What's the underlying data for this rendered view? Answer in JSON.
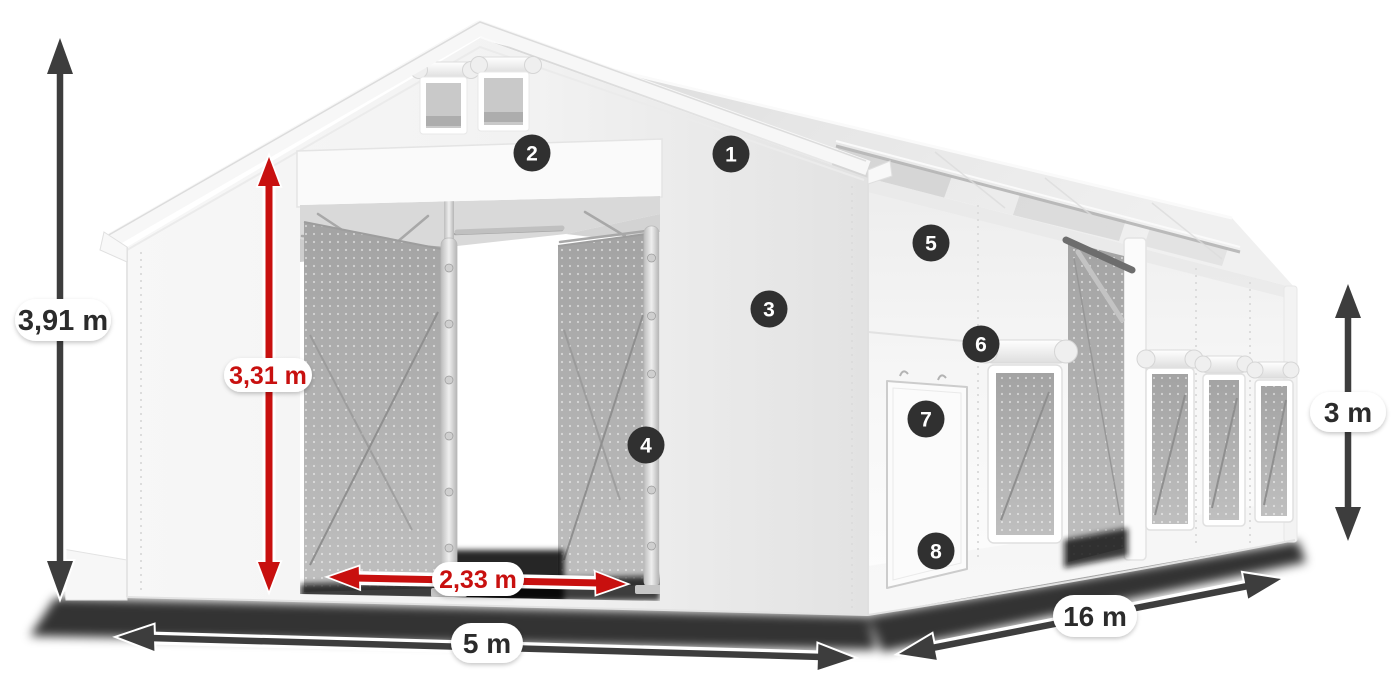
{
  "illustration": {
    "title": "Tent dimensions diagram",
    "subject": "White tarpaulin storage tent with open gable doors, side door, mesh windows, numbered feature callouts and dimension arrows"
  },
  "dimensions": {
    "total_height": {
      "label": "3,91 m",
      "style": "dark"
    },
    "inner_height": {
      "label": "3,31 m",
      "style": "red"
    },
    "door_width": {
      "label": "2,33 m",
      "style": "red"
    },
    "front_width": {
      "label": "5 m",
      "style": "dark"
    },
    "side_length": {
      "label": "16 m",
      "style": "dark"
    },
    "side_height": {
      "label": "3 m",
      "style": "dark"
    }
  },
  "callouts": [
    {
      "number": "1"
    },
    {
      "number": "2"
    },
    {
      "number": "3"
    },
    {
      "number": "4"
    },
    {
      "number": "5"
    },
    {
      "number": "6"
    },
    {
      "number": "7"
    },
    {
      "number": "8"
    }
  ],
  "colors": {
    "dimension_red": "#c8100f",
    "dimension_dark": "#3d3d3d",
    "badge_background": "#303030",
    "badge_text": "#ffffff",
    "tent_white": "#f8f8f8",
    "mesh_gray": "#b2b2b2"
  }
}
